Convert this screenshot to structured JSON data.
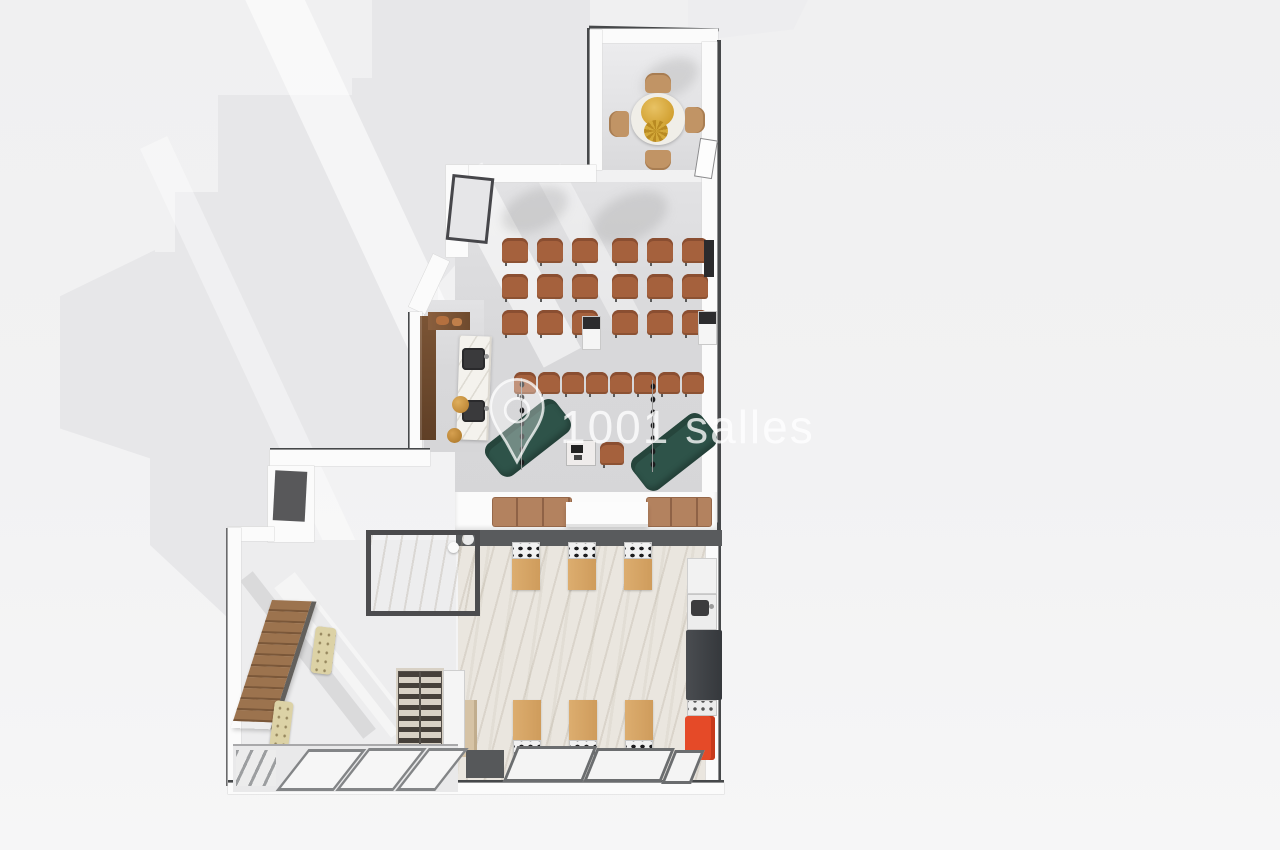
{
  "watermark": {
    "text": "1001 salles",
    "icon": "location-pin-icon",
    "color": "#ffffff"
  },
  "palette": {
    "background": "#f2f2f3",
    "cast_shadow": "#e7e7e9",
    "wall_white": "#fbfbfb",
    "wall_dark_line": "#46484a",
    "hall_floor": "#d8d8da",
    "marble_floor": "#eae6df",
    "theater_chair": "#a5613d",
    "top_room_chair": "#c19465",
    "sofa_green": "#2e5349",
    "bar_wood": "#7b5435",
    "bar_marble": "#f4f2ed",
    "gold": "#c9943f",
    "station_wood": "#d8a768",
    "fridge_dark": "#3f4246",
    "appliance_red": "#e54a28",
    "stair_wood": "#9c734e",
    "bench_beige": "#dcd2a6",
    "banquette_tan": "#b3825f"
  },
  "floorplan": {
    "areas": [
      "private-dining-room",
      "main-hall",
      "bar",
      "kitchen",
      "stair-hall",
      "storage-room",
      "terrace"
    ],
    "top_room": {
      "chairs": 4,
      "table": "round-table-gold-centerpiece"
    },
    "theater_seating": {
      "rows": [
        {
          "groups": [
            3,
            3
          ]
        },
        {
          "groups": [
            3,
            3
          ]
        },
        {
          "groups": [
            3,
            3
          ]
        },
        {
          "groups": [
            8
          ]
        }
      ]
    },
    "lounge": {
      "sofas": 2,
      "cafe_tables": 1,
      "cafe_chairs": 1,
      "light_strips": 2
    },
    "bar": {
      "sinks": 2,
      "stools": 2
    },
    "divider": {
      "banquette_benches": 2,
      "white_table": 1
    },
    "kitchen": {
      "stations_top": 3,
      "stations_bottom": 3,
      "burners_per_station": 4,
      "appliances": [
        "cabinet",
        "sink-unit",
        "fridge",
        "oven",
        "red-appliance"
      ]
    },
    "stair_hall": {
      "stair_steps": 11,
      "tufted_benches": 2,
      "wine_racks": 2
    },
    "terrace": {
      "glass_panels": 3
    }
  }
}
